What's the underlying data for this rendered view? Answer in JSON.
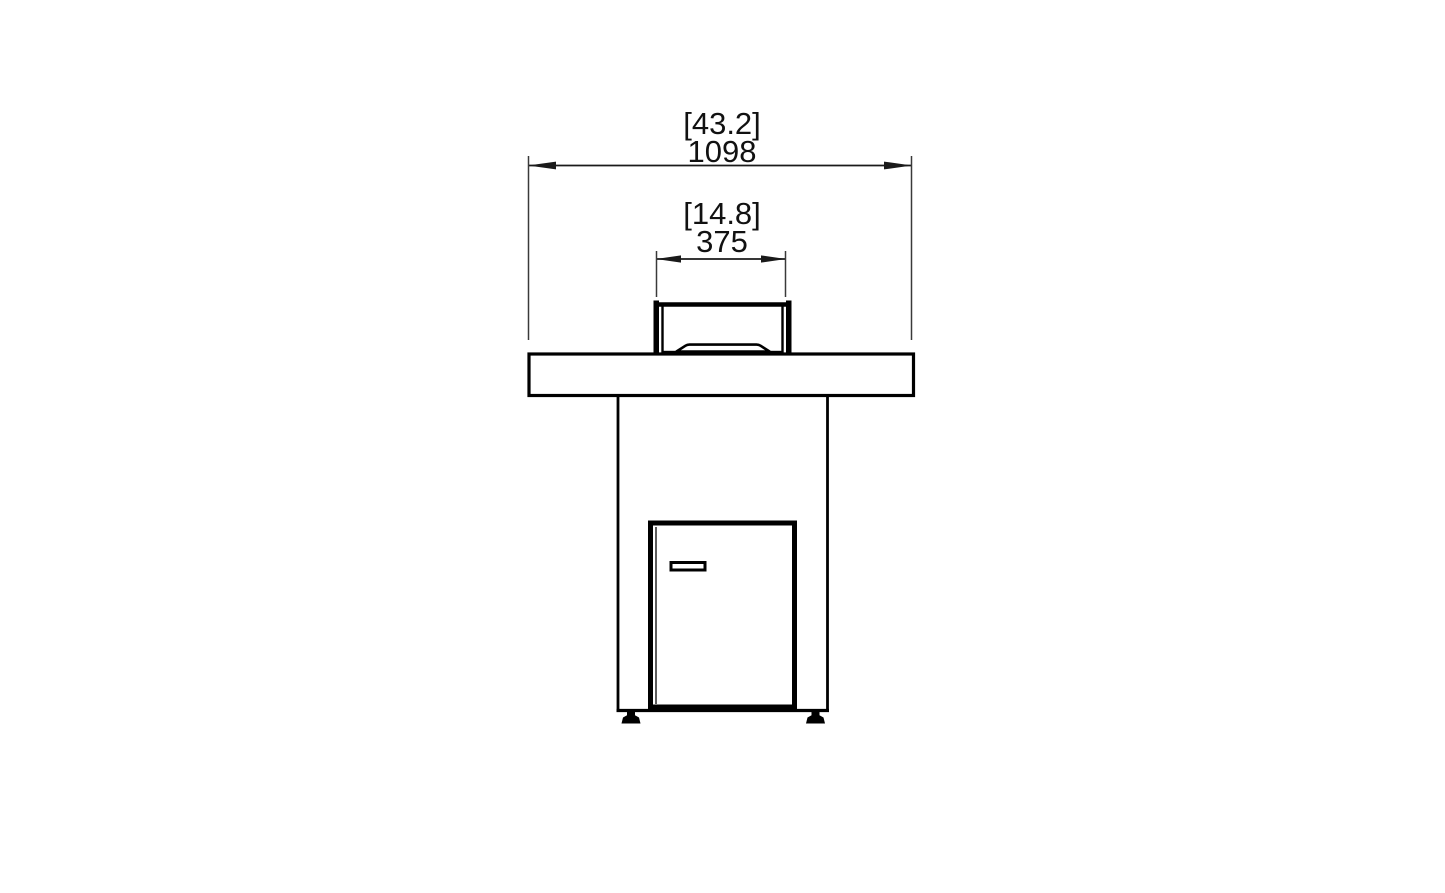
{
  "page": {
    "background_color": "#ffffff",
    "drawing_type": "technical dimension drawing (front elevation)",
    "subject": "fire pit bar table with windscreen, pedestal base, access door and leveling feet"
  },
  "dimensions": {
    "overall_width": {
      "imperial_in": "[43.2]",
      "metric_mm": "1098"
    },
    "burner_width": {
      "imperial_in": "[14.8]",
      "metric_mm": "375"
    }
  },
  "style": {
    "line_color": "#000000",
    "extension_line_color": "#3a3a3a",
    "text_color": "#111111",
    "background": "#ffffff"
  }
}
